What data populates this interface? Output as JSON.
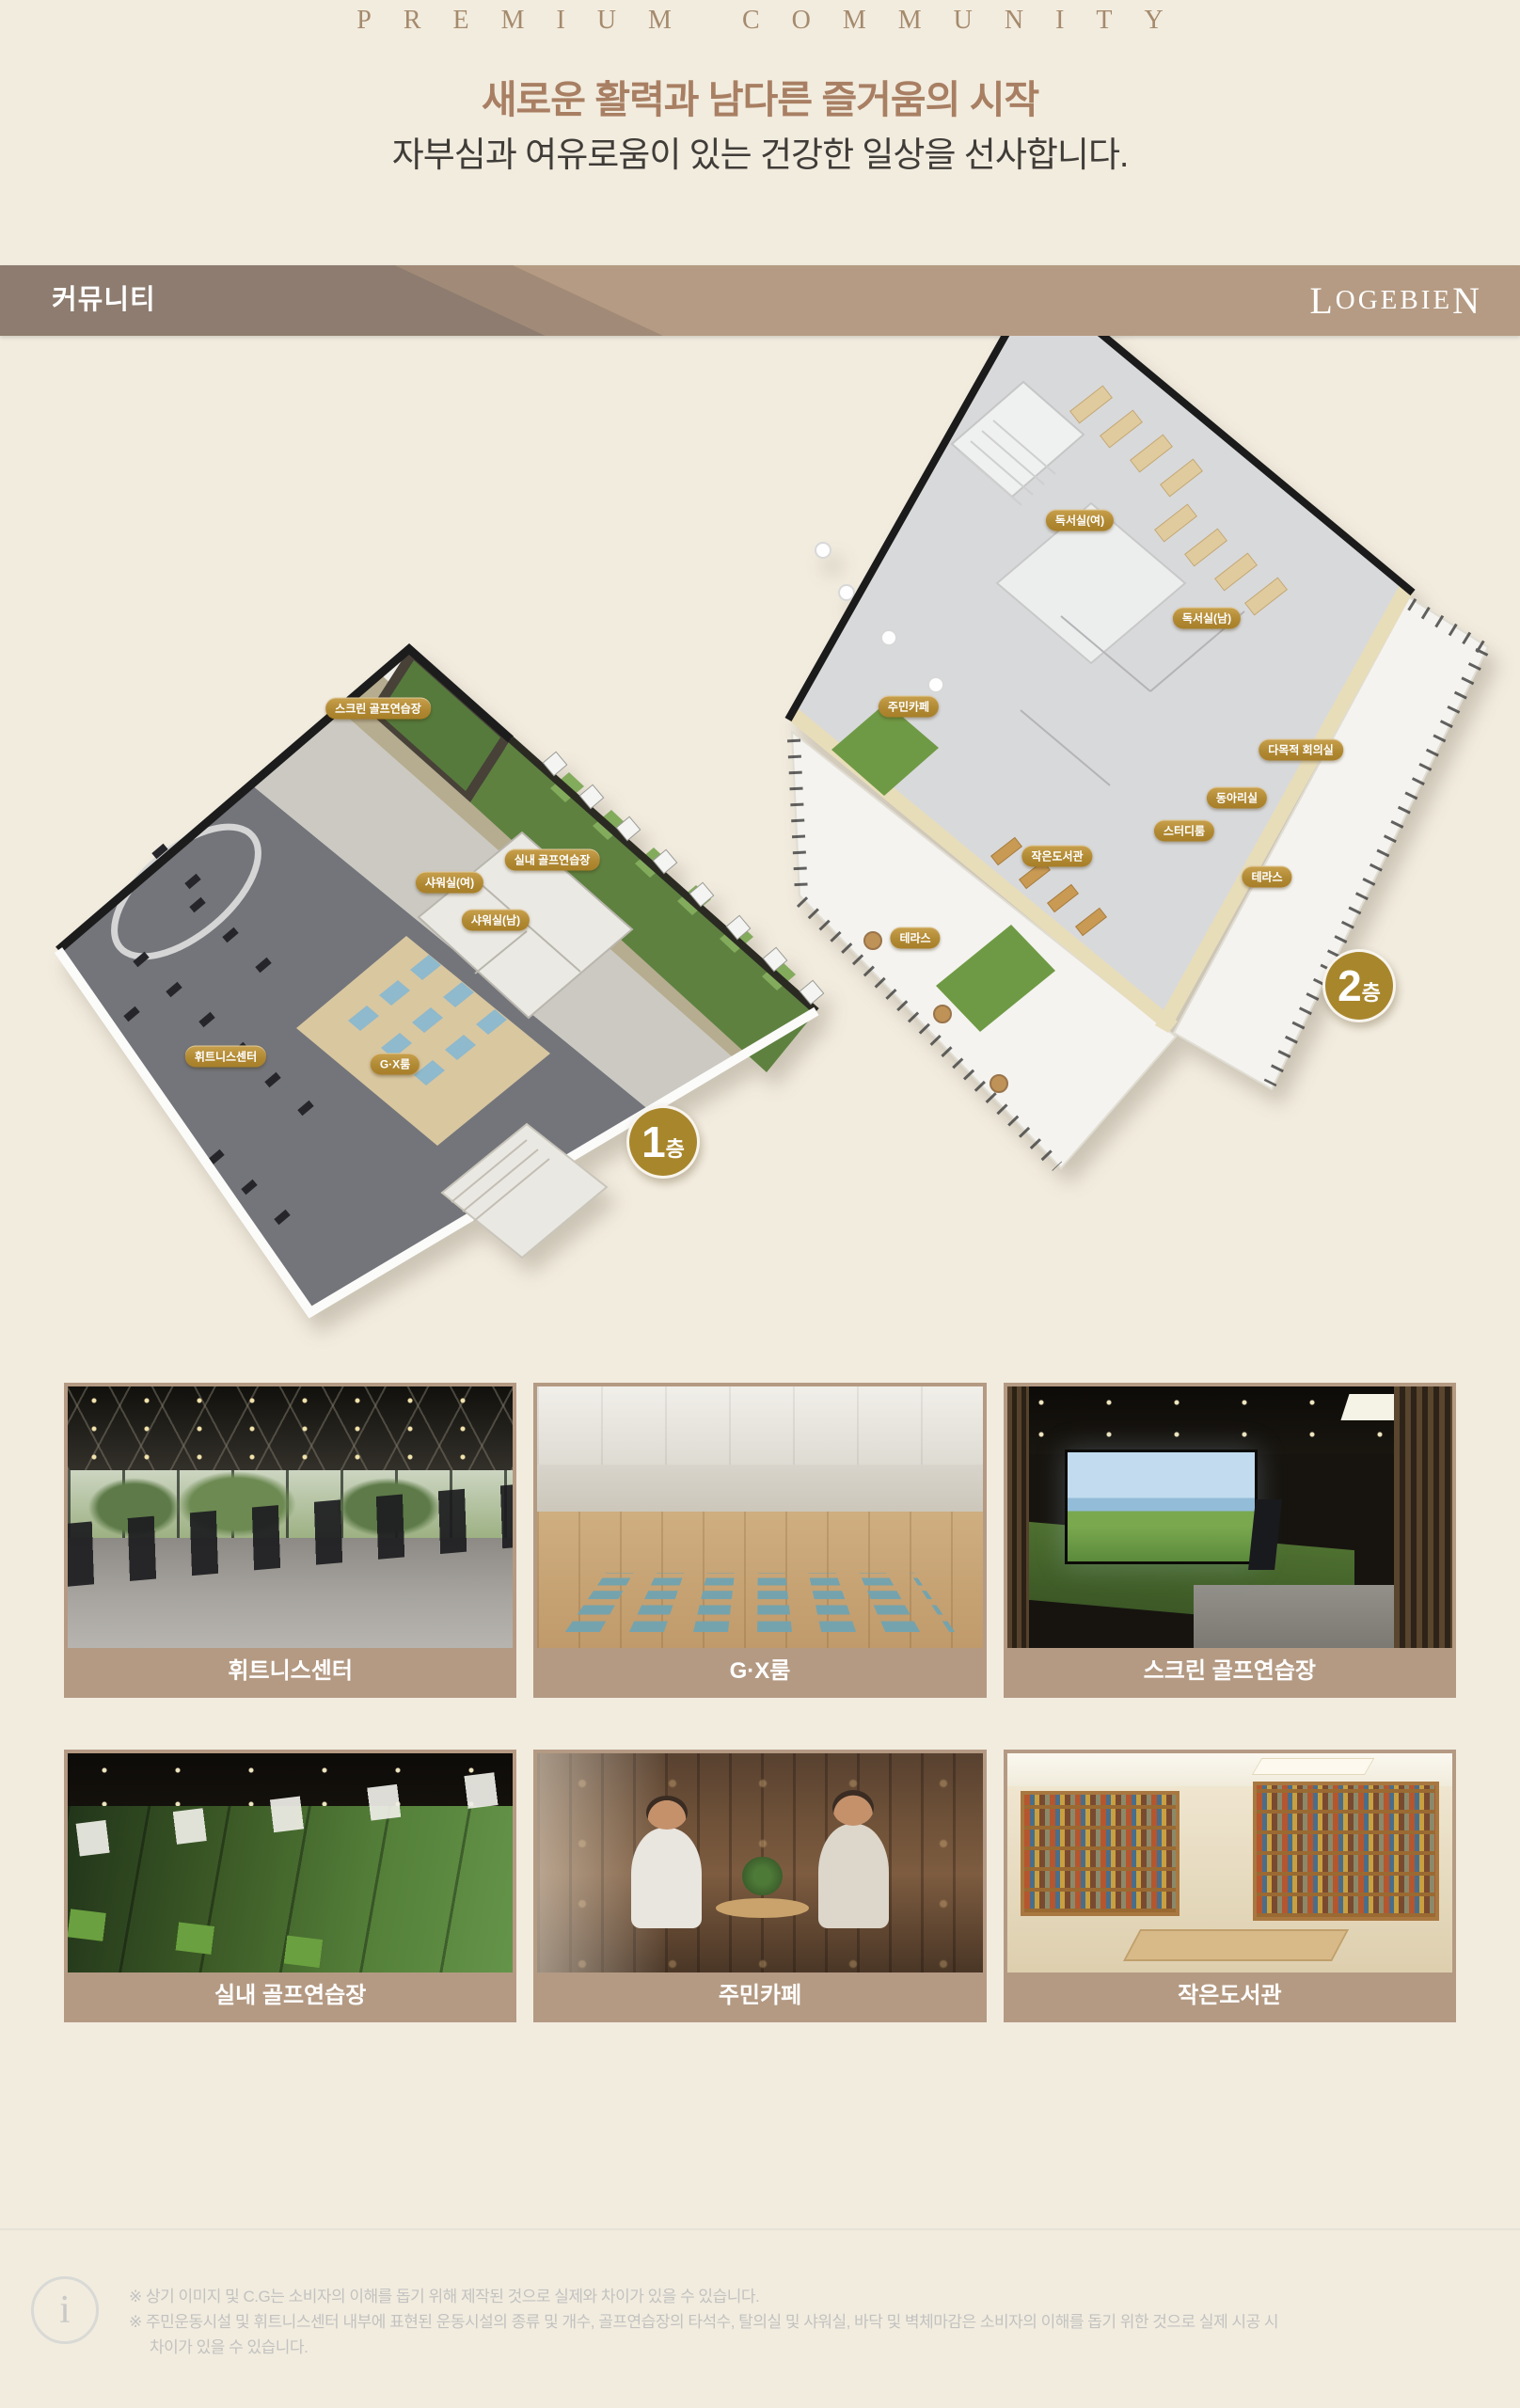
{
  "page": {
    "eyebrow": "PREMIUM COMMUNITY",
    "title": "새로운 활력과 남다른 즐거움의 시작",
    "subtitle": "자부심과 여유로움이 있는 건강한 일상을 선사합니다."
  },
  "section_bar": {
    "label": "커뮤니티",
    "brand_first": "L",
    "brand_mid": "OGEBIE",
    "brand_last": "N"
  },
  "floorplan": {
    "floor1": {
      "badge_num": "1",
      "badge_unit": "층",
      "labels": [
        "스크린 골프연습장",
        "실내 골프연습장",
        "샤워실(여)",
        "샤워실(남)",
        "휘트니스센터",
        "G·X룸"
      ]
    },
    "floor2": {
      "badge_num": "2",
      "badge_unit": "층",
      "labels": [
        "독서실(여)",
        "독서실(남)",
        "주민카페",
        "다목적 회의실",
        "동아리실",
        "스터디룸",
        "작은도서관",
        "테라스",
        "테라스"
      ]
    }
  },
  "gallery": [
    {
      "caption": "휘트니스센터"
    },
    {
      "caption": "G·X룸"
    },
    {
      "caption": "스크린 골프연습장"
    },
    {
      "caption": "실내 골프연습장"
    },
    {
      "caption": "주민카페"
    },
    {
      "caption": "작은도서관"
    }
  ],
  "footnotes": {
    "icon": "i",
    "lines": [
      "※ 상기 이미지 및 C.G는 소비자의 이해를 돕기 위해 제작된 것으로 실제와 차이가 있을 수 있습니다.",
      "※ 주민운동시설 및 휘트니스센터 내부에 표현된 운동시설의 종류 및 개수, 골프연습장의 타석수, 탈의실 및 샤워실, 바닥 및 벽체마감은 소비자의 이해를 돕기 위한 것으로 실제 시공 시",
      "차이가 있을 수 있습니다."
    ]
  },
  "colors": {
    "page_bg": "#f2ecdf",
    "accent_gold": "#a8862c",
    "pill_gold": "#b18a34",
    "caption_tan": "#b49a83",
    "bar_dark": "#8d7c6f",
    "bar_light": "#b59b83",
    "title_brown": "#a87f63"
  }
}
